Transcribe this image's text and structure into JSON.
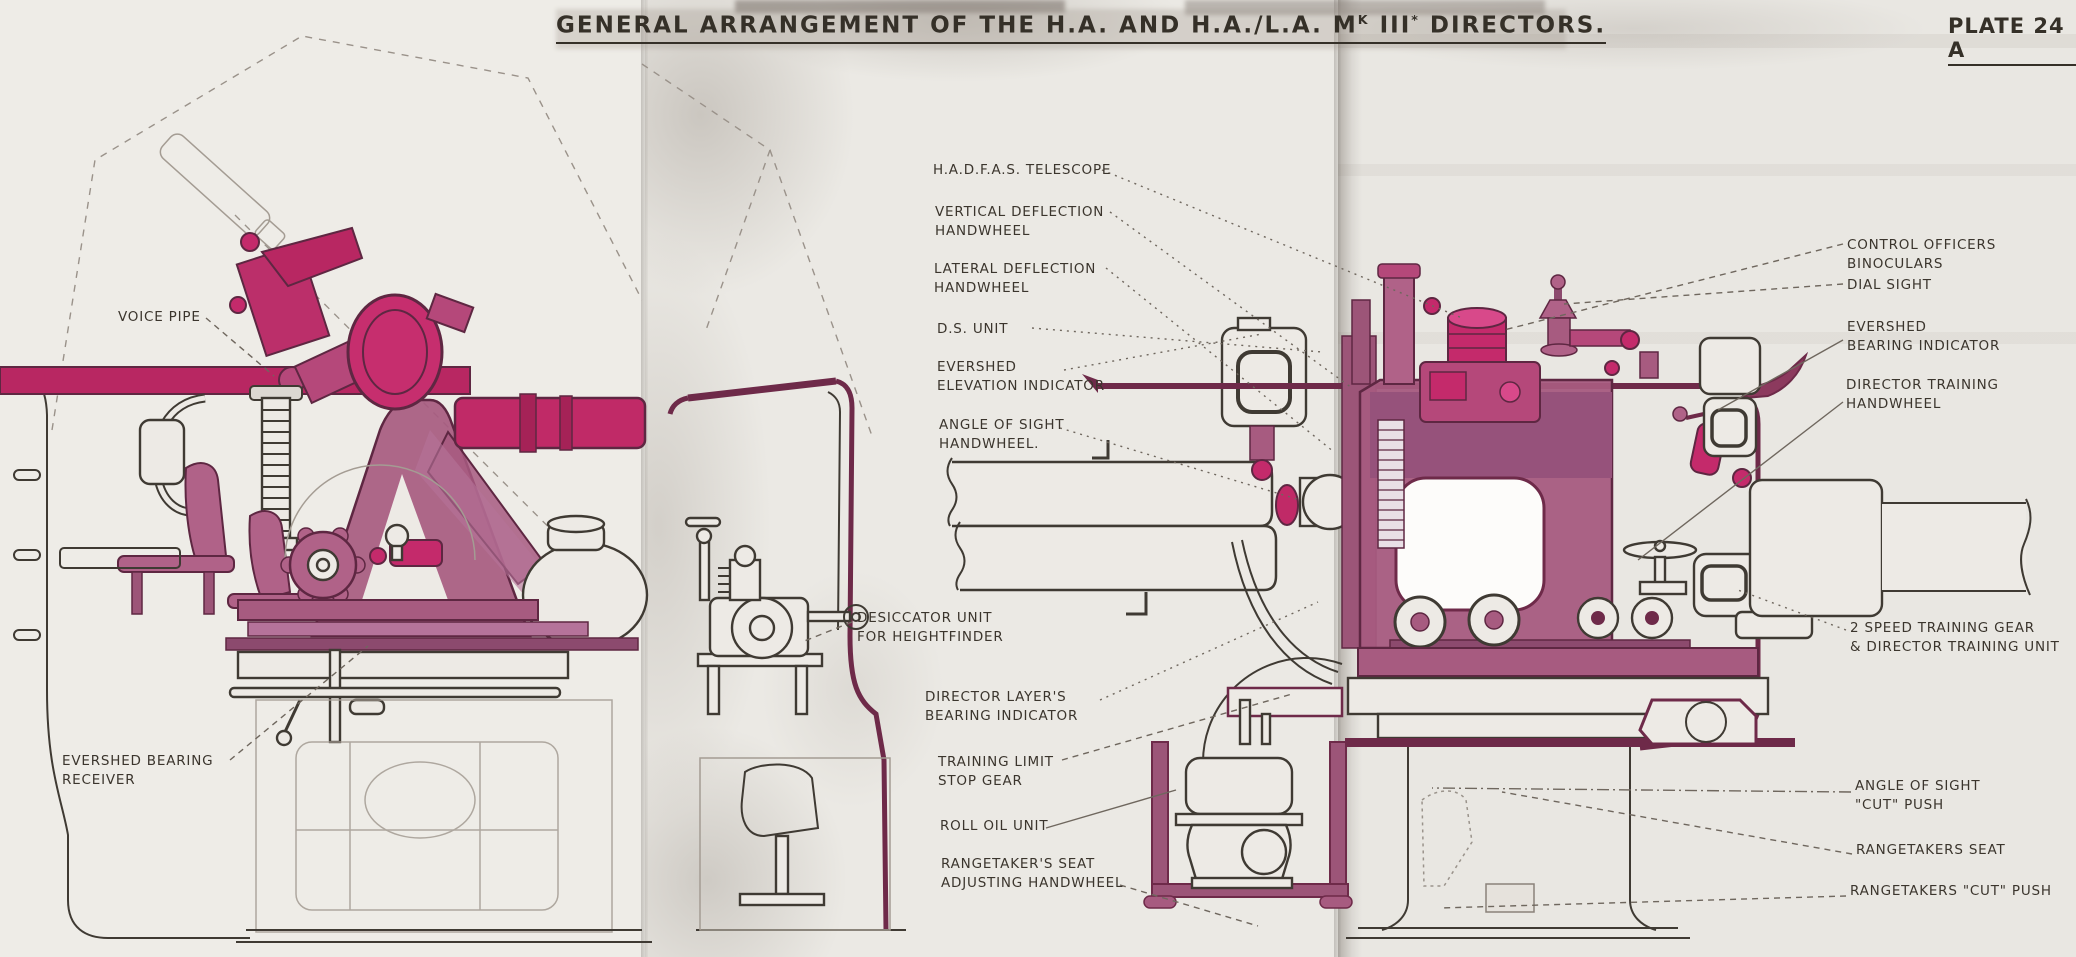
{
  "plate": {
    "title_prefix": "GENERAL ARRANGEMENT OF THE H.A. AND H.A./L.A. M",
    "title_mark_sup": "K",
    "title_mark": " III",
    "title_star": "*",
    "title_suffix": " DIRECTORS.",
    "plate_no": "PLATE 24 A"
  },
  "labels": {
    "voice_pipe": "VOICE PIPE",
    "evershed_bearing_receiver": "EVERSHED BEARING\nRECEIVER",
    "hadfas_telescope": "H.A.D.F.A.S. TELESCOPE",
    "vertical_deflection_handwheel": "VERTICAL DEFLECTION\nHANDWHEEL",
    "lateral_deflection_handwheel": "LATERAL DEFLECTION\nHANDWHEEL",
    "ds_unit": "D.S. UNIT",
    "evershed_elevation_indicator": "EVERSHED\nELEVATION INDICATOR",
    "angle_of_sight_handwheel": "ANGLE OF SIGHT\nHANDWHEEL.",
    "desiccator_unit": "DESICCATOR UNIT\nFOR HEIGHTFINDER",
    "director_layers_bearing_indicator": "DIRECTOR LAYER'S\nBEARING INDICATOR",
    "training_limit_stop_gear": "TRAINING LIMIT\nSTOP GEAR",
    "roll_oil_unit": "ROLL OIL UNIT",
    "rangetakers_seat_adjusting_handwheel": "RANGETAKER'S SEAT\nADJUSTING HANDWHEEL",
    "control_officers_binoculars": "CONTROL OFFICERS BINOCULARS",
    "dial_sight": "DIAL SIGHT",
    "evershed_bearing_indicator": "EVERSHED\nBEARING INDICATOR",
    "director_training_handwheel": "DIRECTOR TRAINING\nHANDWHEEL",
    "two_speed_training_gear": "2 SPEED TRAINING GEAR\n& DIRECTOR TRAINING UNIT",
    "angle_of_sight_cut_push": "ANGLE OF SIGHT\n\"CUT\" PUSH",
    "rangetakers_seat": "RANGETAKERS SEAT",
    "rangetakers_cut_push": "RANGETAKERS \"CUT\" PUSH"
  },
  "colors": {
    "highlight_magenta": "#c42a6b",
    "mid_mauve": "#a75b80",
    "outline_maroon": "#5e2742",
    "ink": "#3f3a33",
    "paper": "#eae7e2"
  }
}
